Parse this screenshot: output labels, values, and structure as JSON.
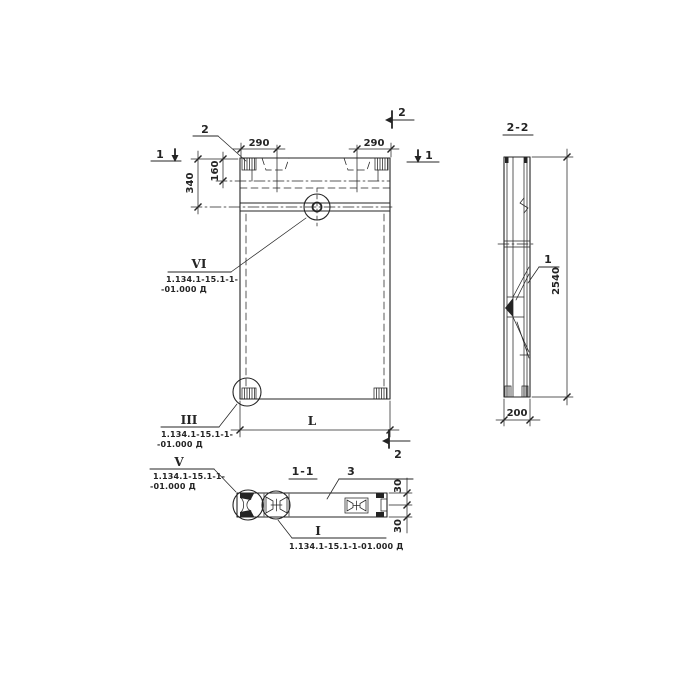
{
  "canvas": {
    "background": "#ffffff",
    "ink": "#242424"
  },
  "front_view": {
    "section_arrow_left_label": "1",
    "section_arrow_right_label": "1",
    "section_mark_top_label": "2",
    "section_mark_bottom_label": "2",
    "dim_290_left": "290",
    "dim_290_right": "290",
    "dim_340": "340",
    "dim_160": "160",
    "dim_length_label": "L",
    "embed_callout_label": "2",
    "detail_vi": {
      "label": "VI",
      "doc_line1": "1.134.1-15.1-1-",
      "doc_line2": "-01.000 Д"
    },
    "detail_iii": {
      "label": "III",
      "doc_line1": "1.134.1-15.1-1-",
      "doc_line2": "-01.000 Д"
    }
  },
  "side_view": {
    "title": "2-2",
    "rib_callout_label": "1",
    "dim_2540": "2540",
    "dim_200": "200"
  },
  "section_1_1": {
    "title": "1-1",
    "slab_callout_label": "3",
    "dim_30_top": "30",
    "dim_30_bottom": "30",
    "detail_v": {
      "label": "V",
      "doc_line1": "1.134.1-15.1-1-",
      "doc_line2": "-01.000 Д"
    },
    "detail_i": {
      "label": "I",
      "doc_line": "1.134.1-15.1-1-01.000 Д"
    }
  }
}
